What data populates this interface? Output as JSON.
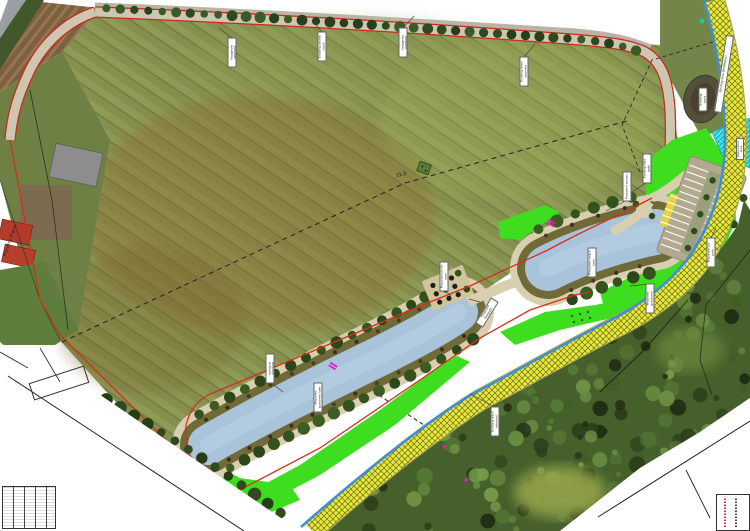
{
  "map": {
    "place_label": "Poultry Farm",
    "measurement_text": "11.3"
  },
  "colors": {
    "boundary_red": "#c62b1c",
    "water_blue": "#a9c3da",
    "ditch_blue": "#3f8fd4",
    "lane_yellow": "#e8e838",
    "proposed_green": "#3fdd1f",
    "attenuation_cyan": "#3fe3e0",
    "gate_magenta": "#e31bc3",
    "bank_olive": "#6f6a38",
    "path_beige": "#d8cfae",
    "carpark_grey": "#b3a98f"
  },
  "annotations": [
    {
      "text": "Existing hedgerow retained",
      "x": 232,
      "y": 52,
      "rot": -90,
      "lead": [
        232,
        38,
        219,
        28
      ]
    },
    {
      "text": "Existing access track",
      "x": 322,
      "y": 46,
      "rot": -90,
      "lead": [
        322,
        32,
        312,
        20
      ]
    },
    {
      "text": "Proposed hedgerow planting",
      "x": 403,
      "y": 42,
      "rot": -90,
      "lead": [
        403,
        28,
        414,
        16
      ]
    },
    {
      "text": "Existing trees retained",
      "x": 524,
      "y": 71,
      "rot": -90,
      "lead": [
        524,
        57,
        535,
        44
      ]
    },
    {
      "text": "Proposed access",
      "x": 627,
      "y": 186,
      "rot": -90,
      "lead": [
        627,
        200,
        606,
        211
      ]
    },
    {
      "text": "Existing field gate",
      "x": 647,
      "y": 168,
      "rot": -90,
      "lead": [
        647,
        182,
        625,
        197
      ]
    },
    {
      "text": "Existing pond",
      "x": 703,
      "y": 99,
      "rot": -90,
      "w": 24,
      "h": 9
    },
    {
      "text": "Attenuation area",
      "x": 740,
      "y": 149,
      "rot": -90,
      "w": 22,
      "h": 8
    },
    {
      "text": "Existing lane (bridleway)",
      "x": 724,
      "y": 74,
      "rot": -81,
      "w": 78,
      "h": 8
    },
    {
      "text": "Proposed car park",
      "x": 711,
      "y": 252,
      "rot": -90,
      "lead": [
        711,
        238,
        716,
        228
      ]
    },
    {
      "text": "Proposed match lake",
      "x": 592,
      "y": 262,
      "rot": -90
    },
    {
      "text": "Proposed grassland",
      "x": 650,
      "y": 298,
      "rot": -90,
      "lead": [
        650,
        284,
        630,
        286
      ]
    },
    {
      "text": "Proposed picnic area",
      "x": 444,
      "y": 276,
      "rot": -90,
      "lead": [
        444,
        290,
        451,
        296
      ]
    },
    {
      "text": "Proposed footpath",
      "x": 487,
      "y": 312,
      "rot": -58,
      "lead": [
        480,
        302,
        469,
        299
      ]
    },
    {
      "text": "Proposed marginal planting",
      "x": 270,
      "y": 368,
      "rot": -90,
      "lead": [
        270,
        382,
        283,
        392
      ]
    },
    {
      "text": "Proposed specimen lake",
      "x": 318,
      "y": 397,
      "rot": -90
    },
    {
      "text": "Existing ditch retained",
      "x": 495,
      "y": 421,
      "rot": -90,
      "lead": [
        495,
        407,
        470,
        394
      ]
    }
  ]
}
